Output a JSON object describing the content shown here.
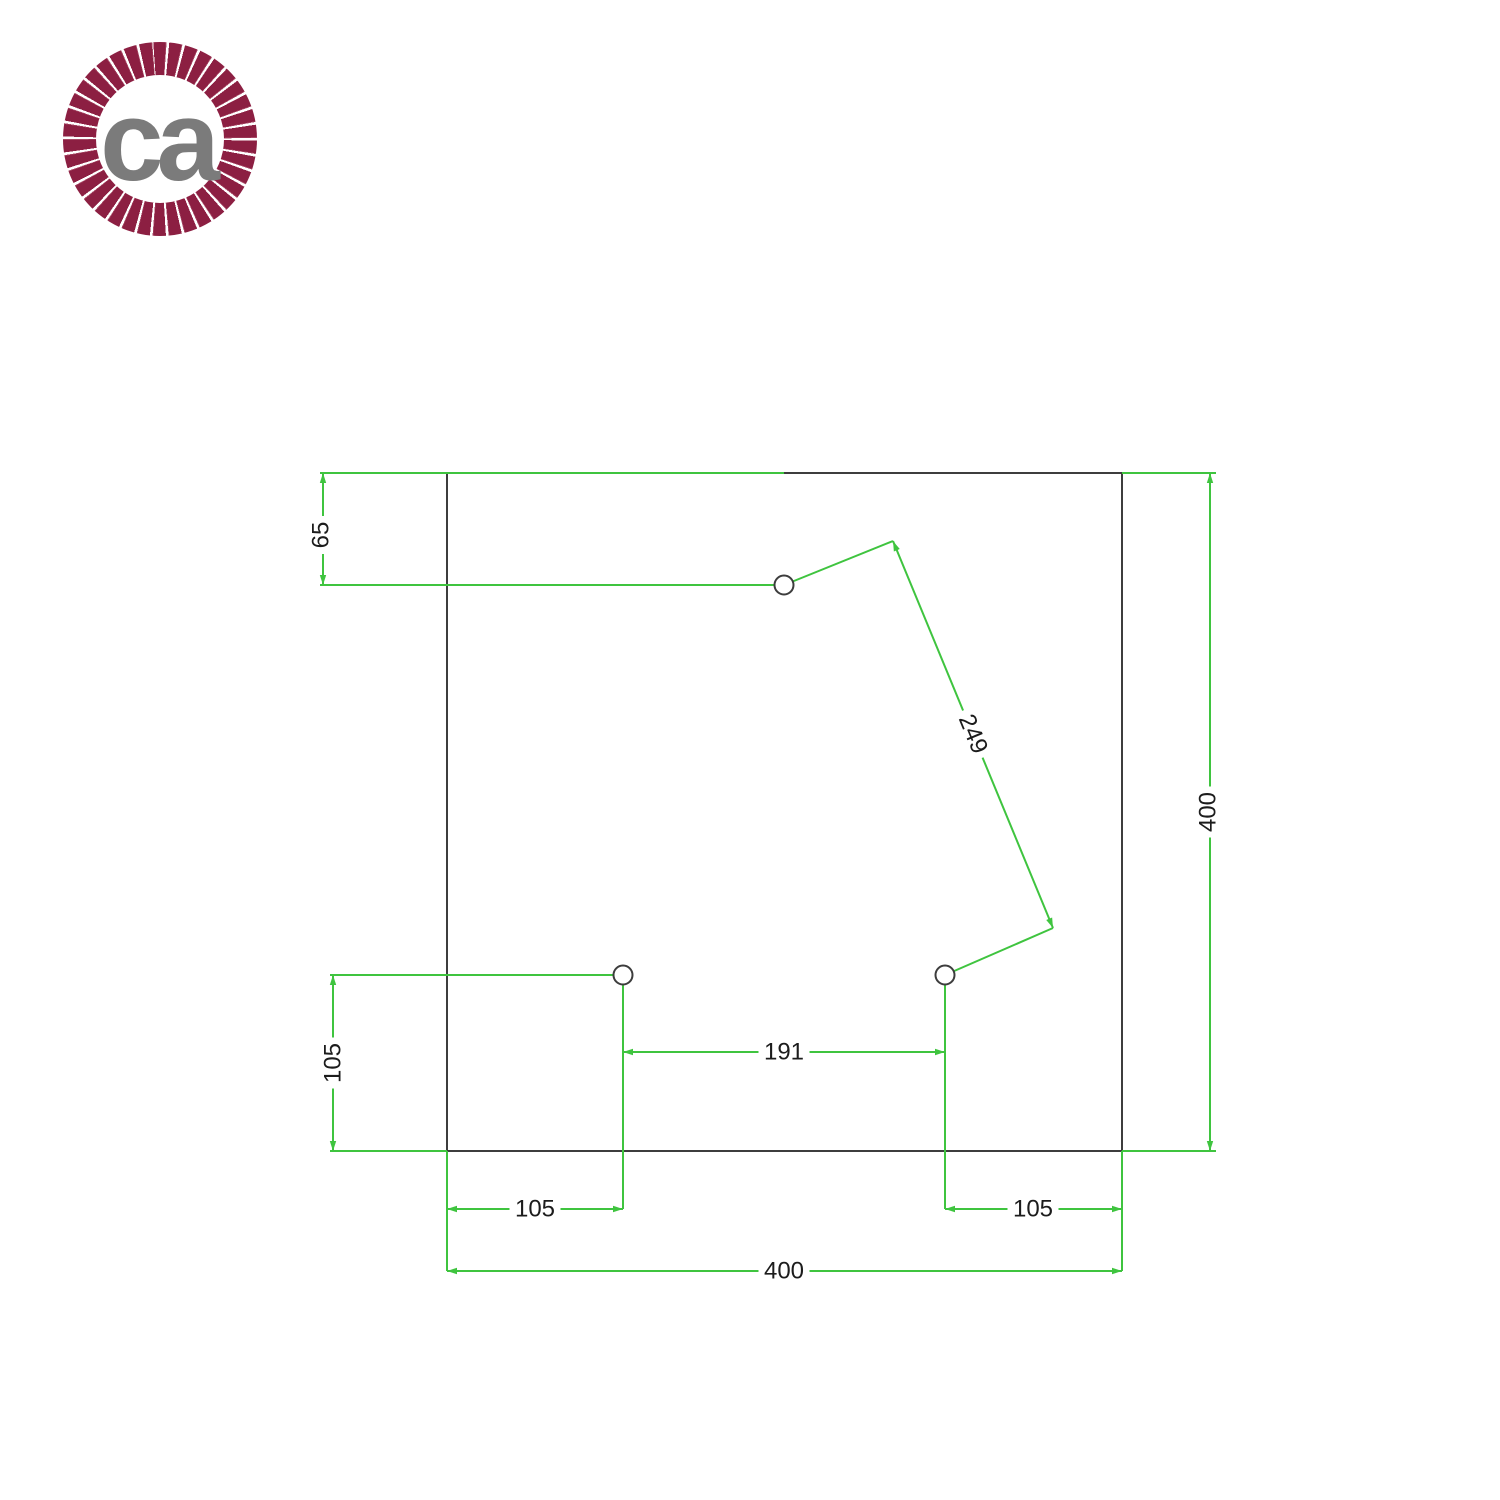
{
  "logo": {
    "text": "ca",
    "ring_color": "#8c1f42",
    "ring_gap_color": "#ffffff",
    "text_color": "#7b7b7b"
  },
  "drawing": {
    "units_note": "square ceiling rose plate with 3 holes, dimensions in mm",
    "colors": {
      "outline": "#3d3d3d",
      "dimension": "#3fc43f",
      "label_text": "#1c1c1c",
      "label_bg": "#ffffff"
    },
    "stroke_width": 2,
    "label_font_size": 24,
    "square": {
      "x": 447,
      "y": 473,
      "width": 675,
      "height": 678,
      "size_mm": 400
    },
    "hole_radius": 9.5,
    "holes": [
      {
        "name": "hole-top-center",
        "cx": 784,
        "cy": 585
      },
      {
        "name": "hole-bottom-left",
        "cx": 623,
        "cy": 975
      },
      {
        "name": "hole-bottom-right",
        "cx": 945,
        "cy": 975
      }
    ],
    "dimensions": [
      {
        "name": "dim-65-left-top",
        "label": "65",
        "value_mm": 65,
        "x1": 323,
        "y1": 473,
        "x2": 323,
        "y2": 585,
        "lx": 321,
        "ly": 535,
        "rot": -90,
        "ext": [
          [
            320,
            473,
            784,
            473
          ],
          [
            320,
            585,
            784,
            585
          ]
        ]
      },
      {
        "name": "dim-105-left",
        "label": "105",
        "value_mm": 105,
        "x1": 333,
        "y1": 975,
        "x2": 333,
        "y2": 1151,
        "lx": 333,
        "ly": 1063,
        "rot": -90,
        "ext": [
          [
            330,
            975,
            623,
            975
          ],
          [
            330,
            1151,
            447,
            1151
          ]
        ]
      },
      {
        "name": "dim-191-between-holes",
        "label": "191",
        "value_mm": 191,
        "x1": 623,
        "y1": 1052,
        "x2": 945,
        "y2": 1052,
        "lx": 784,
        "ly": 1052,
        "rot": 0,
        "ext": [
          [
            623,
            975,
            623,
            1209
          ],
          [
            945,
            975,
            945,
            1209
          ]
        ]
      },
      {
        "name": "dim-105-bottom-left",
        "label": "105",
        "value_mm": 105,
        "x1": 447,
        "y1": 1209,
        "x2": 623,
        "y2": 1209,
        "lx": 535,
        "ly": 1209,
        "rot": 0,
        "ext": []
      },
      {
        "name": "dim-105-bottom-right",
        "label": "105",
        "value_mm": 105,
        "x1": 945,
        "y1": 1209,
        "x2": 1122,
        "y2": 1209,
        "lx": 1033,
        "ly": 1209,
        "rot": 0,
        "ext": []
      },
      {
        "name": "dim-400-bottom",
        "label": "400",
        "value_mm": 400,
        "x1": 447,
        "y1": 1271,
        "x2": 1122,
        "y2": 1271,
        "lx": 784,
        "ly": 1271,
        "rot": 0,
        "ext": [
          [
            447,
            1151,
            447,
            1271
          ],
          [
            1122,
            1151,
            1122,
            1271
          ]
        ]
      },
      {
        "name": "dim-400-right",
        "label": "400",
        "value_mm": 400,
        "x1": 1210,
        "y1": 473,
        "x2": 1210,
        "y2": 1151,
        "lx": 1208,
        "ly": 812,
        "rot": -90,
        "ext": [
          [
            1122,
            473,
            1216,
            473
          ],
          [
            1122,
            1151,
            1216,
            1151
          ]
        ]
      },
      {
        "name": "dim-249-diagonal",
        "label": "249",
        "value_mm": 249,
        "x1": 893,
        "y1": 541,
        "x2": 1053,
        "y2": 928,
        "lx": 973,
        "ly": 734,
        "rot": 67.5,
        "ext": [
          [
            784,
            585,
            893,
            541
          ],
          [
            945,
            975,
            1053,
            928
          ]
        ]
      }
    ]
  }
}
